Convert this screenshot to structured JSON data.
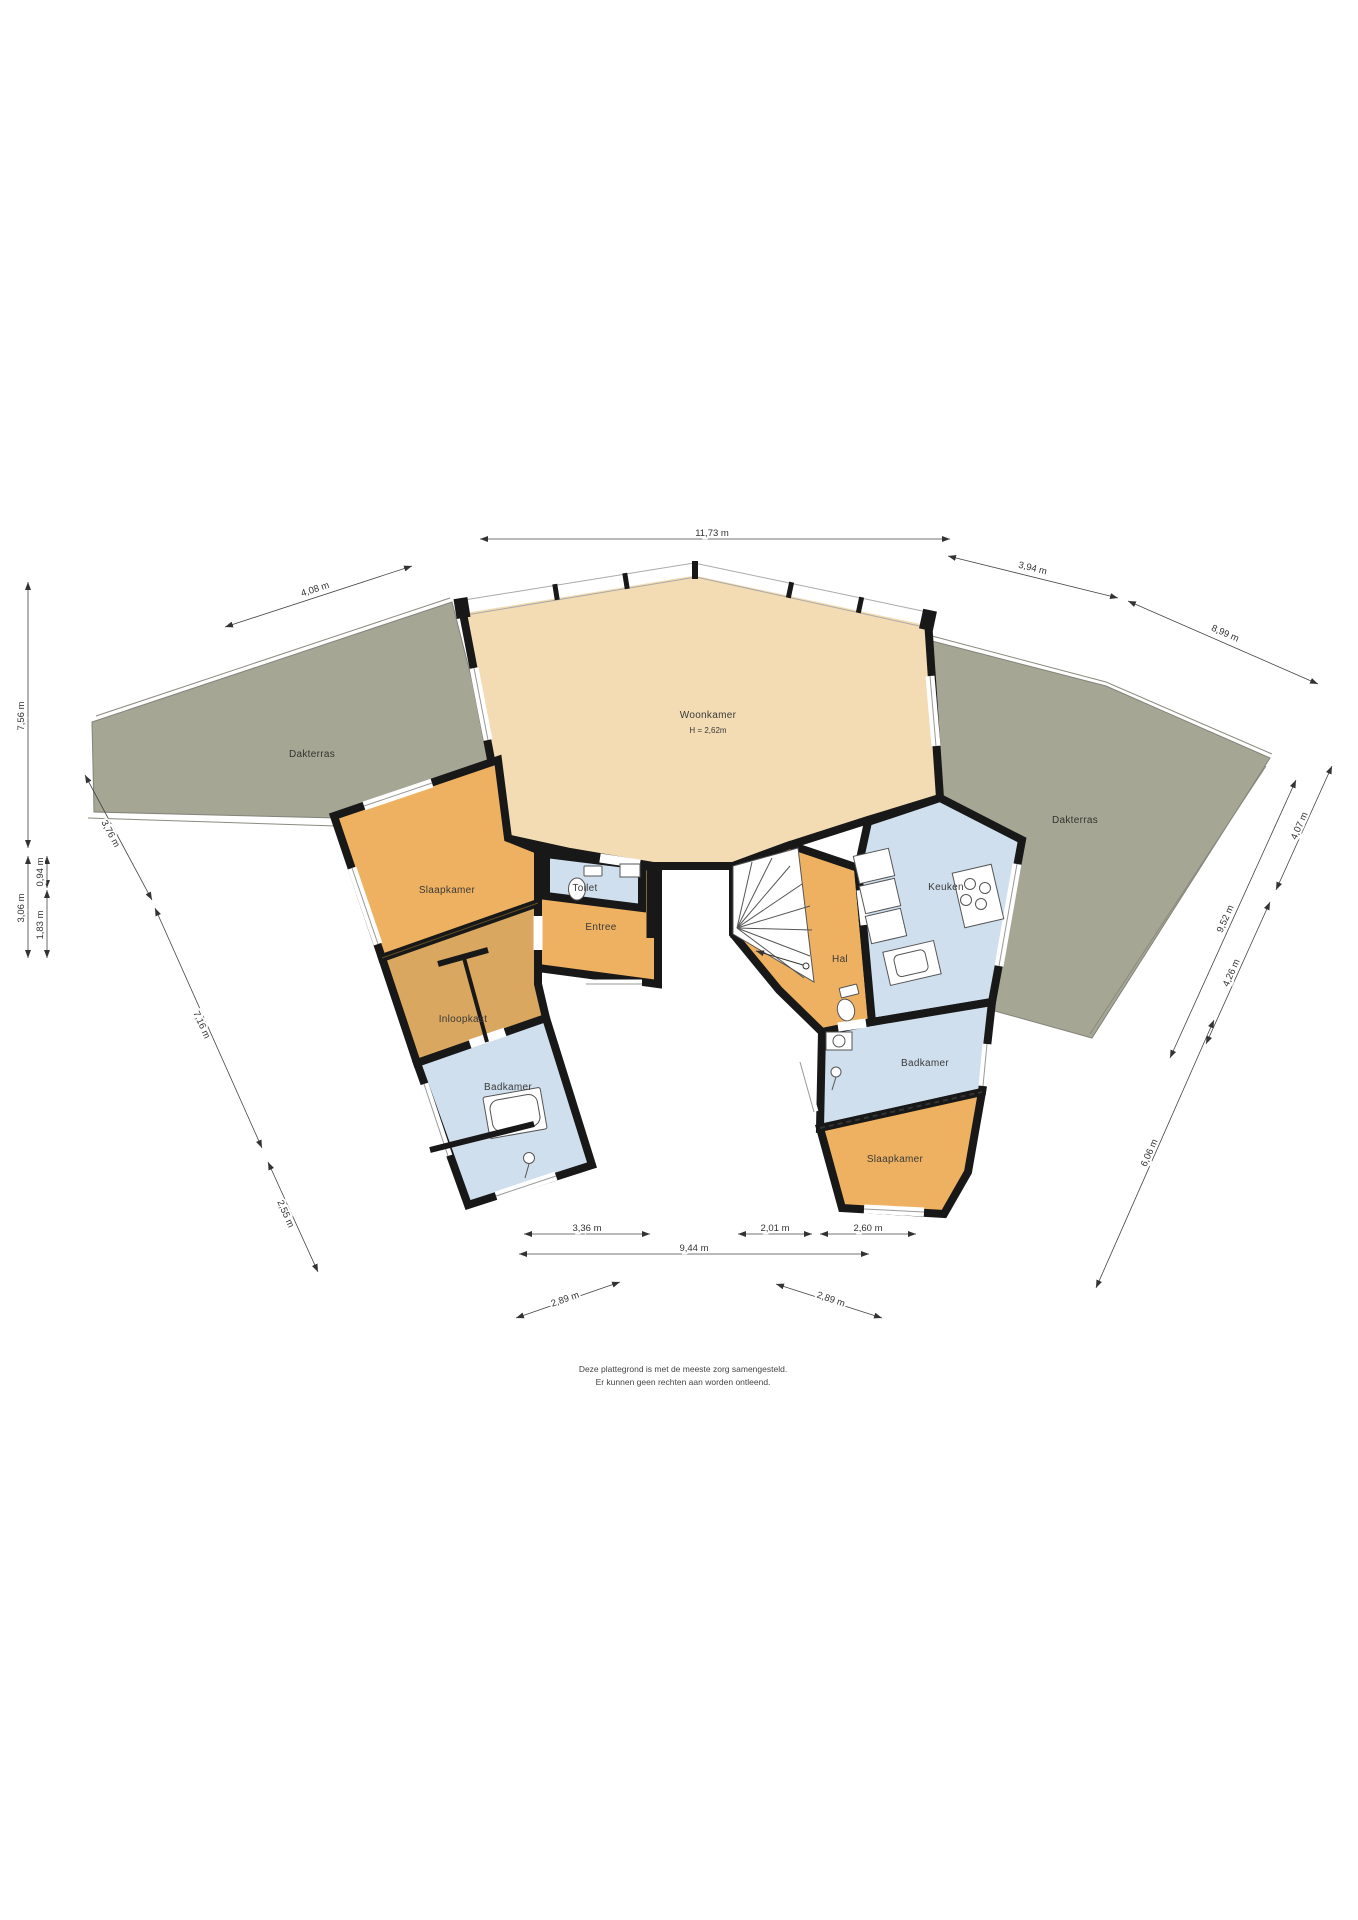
{
  "plan_type": "floorplan",
  "language": "nl",
  "rooms": [
    {
      "id": "woonkamer",
      "label": "Woonkamer",
      "sublabel": "H = 2,62m"
    },
    {
      "id": "slaapkamer-left",
      "label": "Slaapkamer"
    },
    {
      "id": "entree",
      "label": "Entree"
    },
    {
      "id": "toilet",
      "label": "Toilet"
    },
    {
      "id": "inloopkast",
      "label": "Inloopkast"
    },
    {
      "id": "badkamer-left",
      "label": "Badkamer"
    },
    {
      "id": "hal",
      "label": "Hal"
    },
    {
      "id": "keuken",
      "label": "Keuken"
    },
    {
      "id": "badkamer-right",
      "label": "Badkamer"
    },
    {
      "id": "slaapkamer-right",
      "label": "Slaapkamer"
    }
  ],
  "terraces": [
    {
      "id": "dakterras-left",
      "label": "Dakterras"
    },
    {
      "id": "dakterras-right",
      "label": "Dakterras"
    }
  ],
  "dimensions": [
    {
      "id": "top-width",
      "label": "11,73 m"
    },
    {
      "id": "top-left",
      "label": "4,08 m"
    },
    {
      "id": "top-right-1",
      "label": "3,94 m"
    },
    {
      "id": "top-right-2",
      "label": "8,99 m"
    },
    {
      "id": "left-1",
      "label": "7,56 m"
    },
    {
      "id": "left-2",
      "label": "3,06 m"
    },
    {
      "id": "left-3",
      "label": "1,83 m"
    },
    {
      "id": "left-4",
      "label": "0,94 m"
    },
    {
      "id": "left-terrace-diag",
      "label": "3,76 m"
    },
    {
      "id": "left-wing-diag",
      "label": "7,16 m"
    },
    {
      "id": "left-bottom-diag",
      "label": "2,55 m"
    },
    {
      "id": "bottom-1",
      "label": "3,36 m"
    },
    {
      "id": "bottom-2",
      "label": "2,01 m"
    },
    {
      "id": "bottom-3",
      "label": "2,60 m"
    },
    {
      "id": "bottom-total",
      "label": "9,44 m"
    },
    {
      "id": "bottom-left-diag",
      "label": "2,89 m"
    },
    {
      "id": "bottom-right-diag",
      "label": "2,89 m"
    },
    {
      "id": "right-1",
      "label": "4,07 m"
    },
    {
      "id": "right-2",
      "label": "9,52 m"
    },
    {
      "id": "right-3",
      "label": "4,26 m"
    },
    {
      "id": "right-4",
      "label": "6,06 m"
    }
  ],
  "disclaimer": {
    "line1": "Deze plattegrond is met de meeste zorg samengesteld.",
    "line2": "Er kunnen geen rechten aan worden ontleend."
  },
  "colors": {
    "living": "#f3dcb3",
    "room_orange": "#eeb161",
    "closet": "#d9a75f",
    "wet_blue": "#cfdfee",
    "terrace": "#a6a695",
    "wall": "#181818",
    "dim": "#444444",
    "fixture": "#555555"
  }
}
